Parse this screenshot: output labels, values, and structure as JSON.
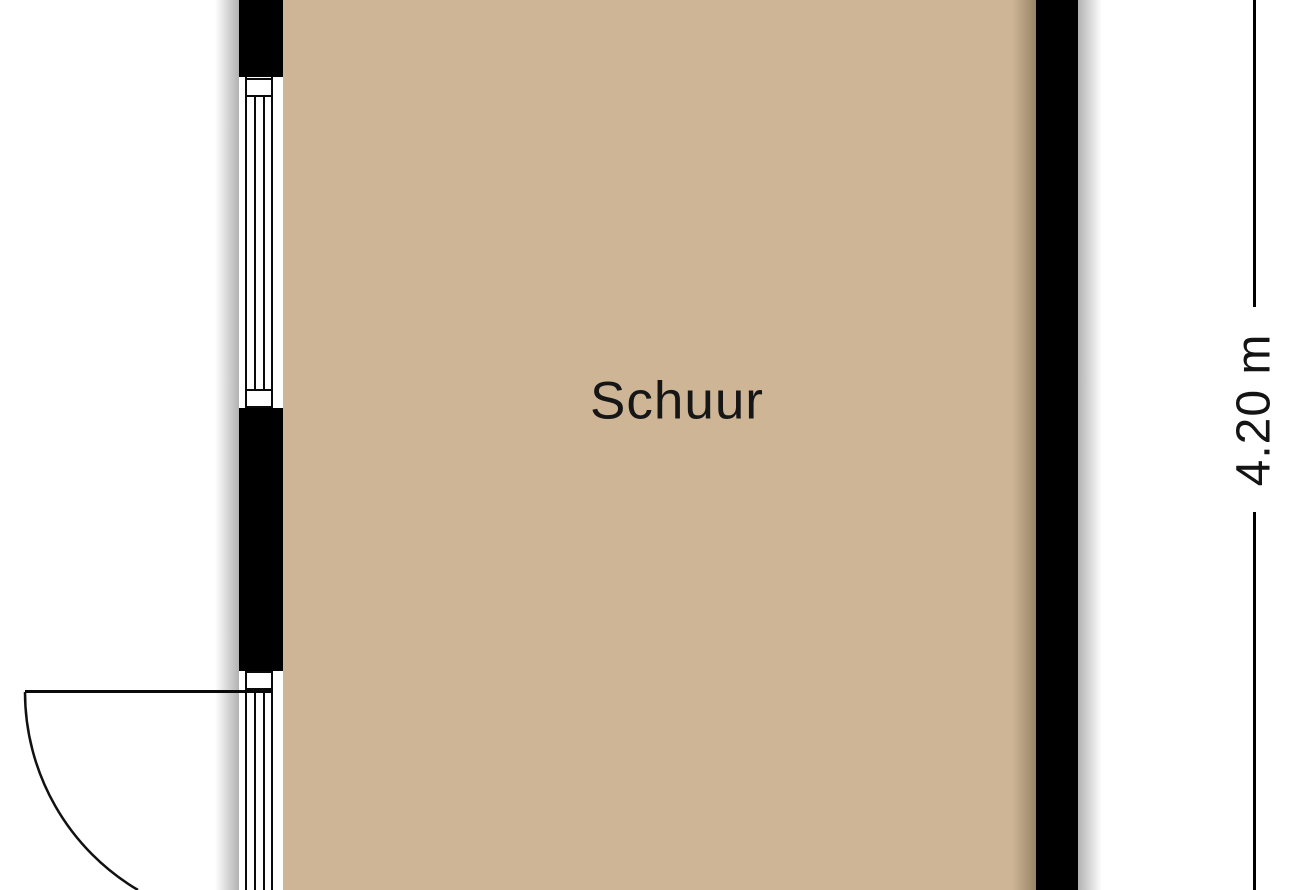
{
  "room": {
    "label": "Schuur"
  },
  "dimension": {
    "label": "4.20 m"
  },
  "colors": {
    "floor": "#cdb596",
    "wall": "#000000",
    "line": "#0a0a0a",
    "text": "#161616",
    "background": "#ffffff"
  },
  "elements": {
    "window": "window",
    "door": "door-with-swing-arc",
    "dimension_line": "vertical-dimension-line"
  }
}
